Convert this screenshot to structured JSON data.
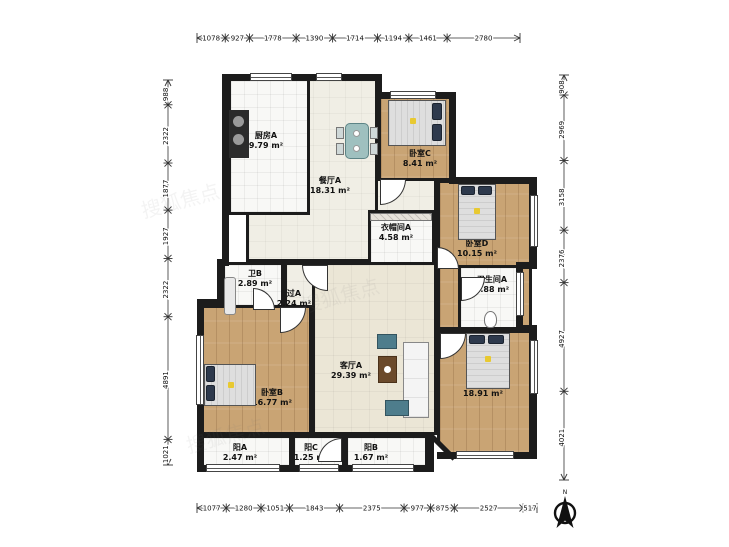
{
  "rooms": [
    {
      "id": "dining-a",
      "name": "餐厅A",
      "area": "18.31 m²",
      "floor": "tile-light",
      "rect": [
        246,
        78,
        132,
        184
      ],
      "label": [
        330,
        176
      ]
    },
    {
      "id": "kitchen-a",
      "name": "厨房A",
      "area": "9.79 m²",
      "floor": "tile-white",
      "rect": [
        228,
        78,
        82,
        137
      ],
      "label": [
        266,
        131
      ]
    },
    {
      "id": "bedroom-c",
      "name": "卧室C",
      "area": "8.41 m²",
      "floor": "wood",
      "rect": [
        378,
        95,
        74,
        86
      ],
      "label": [
        420,
        149
      ]
    },
    {
      "id": "bedroom-d",
      "name": "卧室D",
      "area": "10.15 m²",
      "floor": "wood",
      "rect": [
        437,
        180,
        95,
        150
      ],
      "label": [
        477,
        239
      ]
    },
    {
      "id": "cloakroom-a",
      "name": "衣帽间A",
      "area": "4.58 m²",
      "floor": "tile-white",
      "rect": [
        368,
        210,
        67,
        55
      ],
      "label": [
        396,
        223
      ]
    },
    {
      "id": "bath-b",
      "name": "卫B",
      "area": "2.89 m²",
      "floor": "tile-white",
      "rect": [
        222,
        262,
        62,
        58
      ],
      "label": [
        255,
        269
      ]
    },
    {
      "id": "hall-a",
      "name": "过A",
      "area": "2.24 m²",
      "floor": "tile-light",
      "rect": [
        284,
        262,
        34,
        68
      ],
      "label": [
        294,
        289
      ]
    },
    {
      "id": "bathroom-a",
      "name": "卫生间A",
      "area": "4.88 m²",
      "floor": "tile-white",
      "rect": [
        458,
        265,
        62,
        65
      ],
      "label": [
        492,
        275
      ]
    },
    {
      "id": "bedroom-b",
      "name": "卧室B",
      "area": "16.77 m²",
      "floor": "wood",
      "rect": [
        200,
        305,
        112,
        130
      ],
      "label": [
        272,
        388
      ]
    },
    {
      "id": "living-a",
      "name": "客厅A",
      "area": "29.39 m²",
      "floor": "living",
      "rect": [
        312,
        262,
        125,
        173
      ],
      "label": [
        351,
        361
      ]
    },
    {
      "id": "bedroom-a",
      "name": "卧室A",
      "area": "18.91 m²",
      "floor": "wood",
      "rect": [
        437,
        330,
        95,
        125
      ],
      "label": [
        483,
        379
      ]
    },
    {
      "id": "balcony-a",
      "name": "阳A",
      "area": "2.47 m²",
      "floor": "tile-white",
      "rect": [
        200,
        435,
        92,
        33
      ],
      "label": [
        240,
        443
      ]
    },
    {
      "id": "balcony-c",
      "name": "阳C",
      "area": "1.25 m²",
      "floor": "tile-white",
      "rect": [
        292,
        435,
        53,
        33
      ],
      "label": [
        311,
        443
      ]
    },
    {
      "id": "balcony-b",
      "name": "阳B",
      "area": "1.67 m²",
      "floor": "tile-white",
      "rect": [
        345,
        435,
        83,
        33
      ],
      "label": [
        371,
        443
      ]
    }
  ],
  "dimensions": {
    "top": {
      "values": [
        "1078",
        "927",
        "1778",
        "1390",
        "1714",
        "1194",
        "1461",
        "2780"
      ]
    },
    "bottom": {
      "values": [
        "1077",
        "1280",
        "1051",
        "1843",
        "2375",
        "977",
        "875",
        "2527",
        "517"
      ]
    },
    "left": {
      "values": [
        "988",
        "2322",
        "1877",
        "1927",
        "2322",
        "4891",
        "1021"
      ]
    },
    "right": {
      "values": [
        "908",
        "2969",
        "3158",
        "2376",
        "4927",
        "4021"
      ]
    }
  },
  "compass": {
    "label": "N"
  },
  "watermark": {
    "text": "搜狐焦点"
  },
  "colors": {
    "wall": "#1c1c1c",
    "wood": "#c9a474",
    "tile_white": "#f8f8f6",
    "tile_light": "#f0eee5",
    "living": "#ebe6d6",
    "dim_text": "#111111",
    "accent_pillow": "#2e3a4d",
    "accent_teal": "#4e7d8c"
  }
}
